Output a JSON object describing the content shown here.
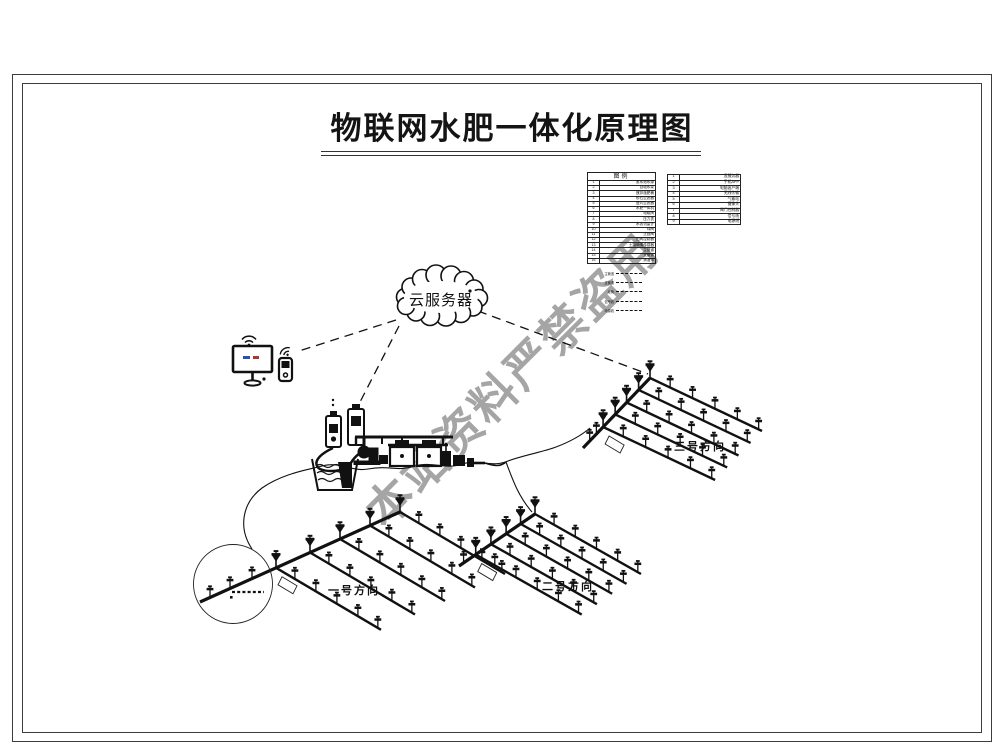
{
  "page": {
    "title": "物联网水肥一体化原理图",
    "watermark": "本站资料严禁盗用"
  },
  "cloud": {
    "label": "云服务器"
  },
  "legend": {
    "title": "图例",
    "main_rows": [
      [
        "1",
        "蓄水池水源"
      ],
      [
        "2",
        "自吸水泵"
      ],
      [
        "3",
        "搅拌施肥桶"
      ],
      [
        "4",
        "砂石过滤器"
      ],
      [
        "5",
        "叠片过滤器"
      ],
      [
        "6",
        "水肥一体机"
      ],
      [
        "7",
        "电磁阀"
      ],
      [
        "8",
        "压力表"
      ],
      [
        "9",
        "水表流量计"
      ],
      [
        "10",
        "球阀"
      ],
      [
        "11",
        "止回阀"
      ],
      [
        "12",
        "田间控制器"
      ],
      [
        "13",
        "土壤墒情传感器"
      ],
      [
        "14",
        "主管道"
      ],
      [
        "15",
        "支管道"
      ],
      [
        "16",
        "滴灌带"
      ]
    ],
    "side_rows": [
      [
        "1",
        "云服务器"
      ],
      [
        "2",
        "手机APP"
      ],
      [
        "3",
        "电脑客户端"
      ],
      [
        "4",
        "无线传输"
      ],
      [
        "5",
        "气象站"
      ],
      [
        "6",
        "摄像头"
      ],
      [
        "7",
        "阀门控制器"
      ],
      [
        "8",
        "信号线"
      ],
      [
        "9",
        "电源线"
      ]
    ],
    "line_items": [
      "主管道",
      "支管道",
      "毛管",
      "信号线",
      "电源线"
    ]
  },
  "fields": [
    {
      "label": "一号方向"
    },
    {
      "label": "二号方向"
    },
    {
      "label": "三号方向"
    }
  ]
}
